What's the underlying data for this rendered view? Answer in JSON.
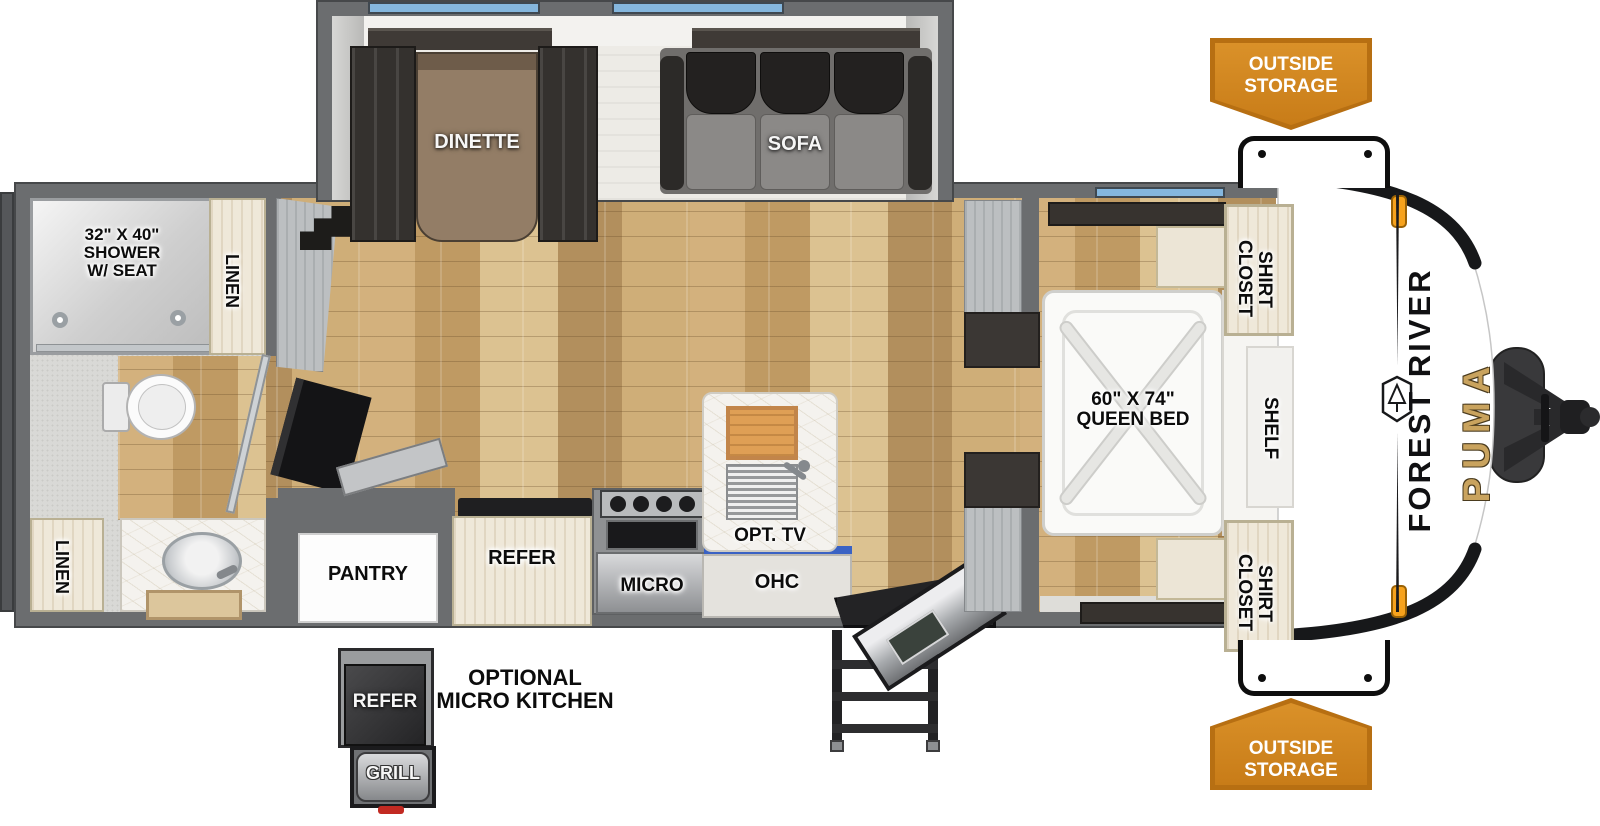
{
  "plan": {
    "brand": {
      "maker": "FOREST RIVER",
      "model": "PUMA"
    },
    "rooms": {
      "shower": "32\" X 40\"\nSHOWER\nW/ SEAT",
      "linen_rear": "LINEN",
      "linen_front": "LINEN",
      "dinette": "DINETTE",
      "sofa": "SOFA",
      "pantry": "PANTRY",
      "refer": "REFER",
      "micro": "MICRO",
      "ohc": "OHC",
      "opt_tv": "OPT. TV",
      "queen_bed": "60\" X 74\"\nQUEEN BED",
      "shirt_closet_top": "SHIRT\nCLOSET",
      "shirt_closet_bottom": "SHIRT\nCLOSET",
      "shelf": "SHELF"
    },
    "exterior": {
      "outside_storage_top": "OUTSIDE\nSTORAGE",
      "outside_storage_bottom": "OUTSIDE\nSTORAGE",
      "optional_micro_kitchen": "OPTIONAL\nMICRO KITCHEN",
      "opt_refer": "REFER",
      "opt_grill": "GRILL"
    },
    "colors": {
      "wall_gray": "#6b6d6f",
      "floor_wood_tan": "#c7a471",
      "window_blue": "#85b7de",
      "ohc_accent_blue": "#3a62c4",
      "banner_orange": "#d2871f",
      "banner_border_orange": "#b76f12",
      "brand_gold": "#c9a35e",
      "marker_light_amber": "#f6a21d"
    }
  }
}
